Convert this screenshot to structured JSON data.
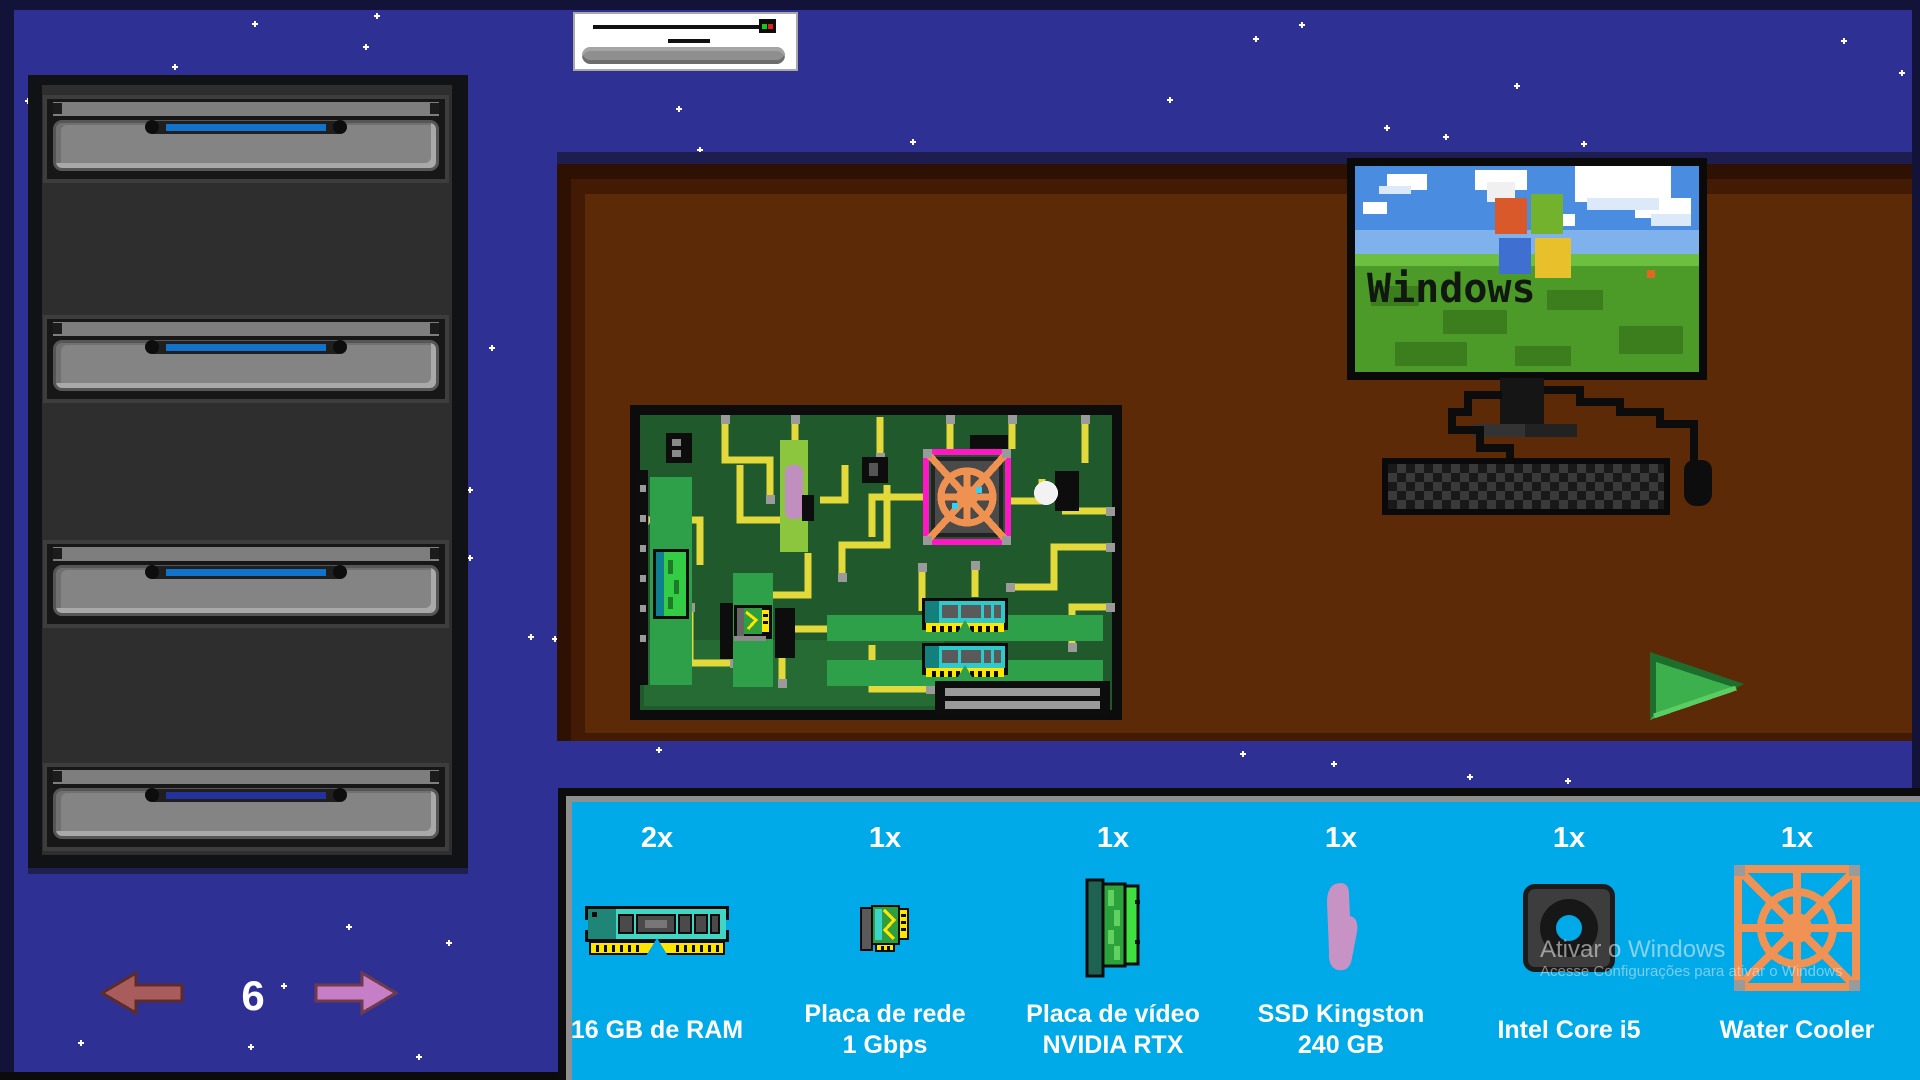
{
  "aircon": {
    "name": "slider-device"
  },
  "cabinet": {
    "drawers": 4
  },
  "pager": {
    "current": "6"
  },
  "monitor": {
    "brand_text": "Windows"
  },
  "watermark": {
    "line1": "Ativar o Windows",
    "line2": "Acesse Configurações para ativar o Windows"
  },
  "inventory": {
    "items": [
      {
        "count": "2x",
        "line1": "16 GB de RAM",
        "line2": ""
      },
      {
        "count": "1x",
        "line1": "Placa de rede",
        "line2": "1 Gbps"
      },
      {
        "count": "1x",
        "line1": "Placa de vídeo",
        "line2": "NVIDIA RTX"
      },
      {
        "count": "1x",
        "line1": "SSD Kingston",
        "line2": "240 GB"
      },
      {
        "count": "1x",
        "line1": "Intel Core i5",
        "line2": ""
      },
      {
        "count": "1x",
        "line1": "Water Cooler",
        "line2": ""
      }
    ]
  },
  "colors": {
    "background": "#2e3193",
    "panel": "#00a9e8",
    "desk": "#5d2a08",
    "handle_blue": "#1273cc",
    "handle_dark": "#23339b",
    "cooler_orange": "#ef9254",
    "arrow_back": "#a85c5c",
    "arrow_next": "#c67ec6"
  }
}
